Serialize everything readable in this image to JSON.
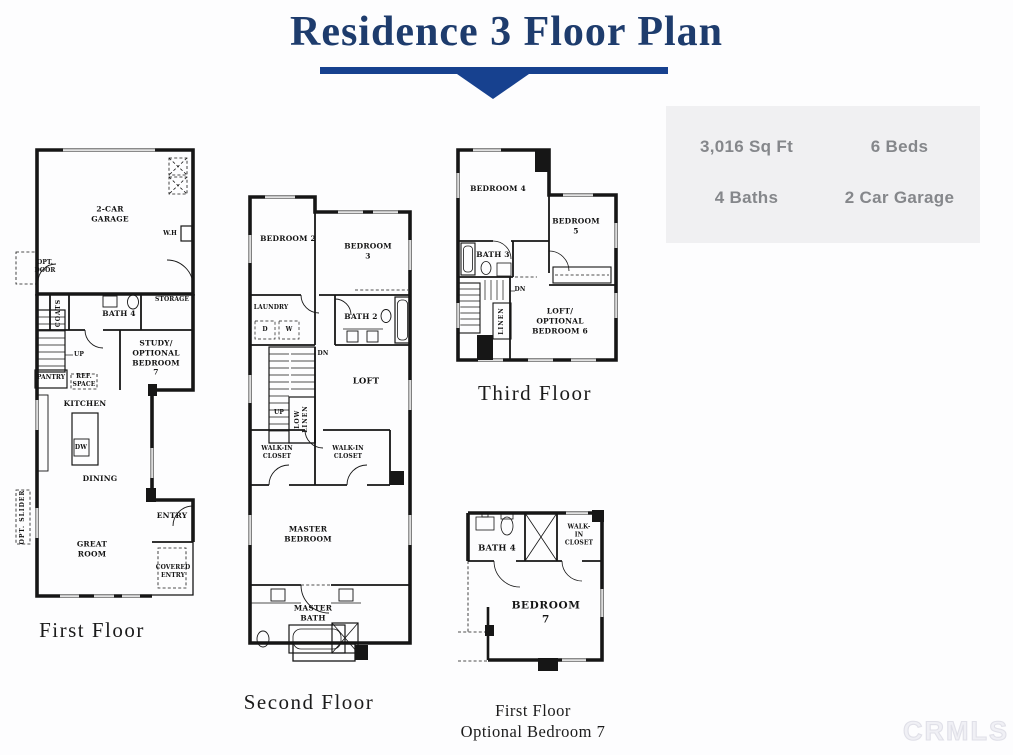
{
  "title": "Residence 3 Floor Plan",
  "stats": {
    "sqft": "3,016 Sq Ft",
    "beds": "6 Beds",
    "baths": "4 Baths",
    "garage": "2 Car Garage"
  },
  "watermark": "CRMLS",
  "colors": {
    "title_blue": "#1e3c6d",
    "bar_blue": "#17418f",
    "panel_gray": "#f0f0f2",
    "stats_text_gray": "#85878b"
  },
  "first_floor": {
    "caption": "First Floor",
    "labels": {
      "garage": "2-CAR\nGARAGE",
      "water_heater": "W.H",
      "opt_door": "OPT.\nDOOR",
      "coats": "COATS",
      "bath4": "BATH 4",
      "storage": "STORAGE",
      "study": "STUDY/\nOPTIONAL\nBEDROOM 7",
      "up": "UP",
      "pantry": "PANTRY",
      "ref_space": "REF.\nSPACE",
      "kitchen": "KITCHEN",
      "dw": "DW",
      "dining": "DINING",
      "opt_slider": "OPT. SLIDER",
      "great_room": "GREAT\nROOM",
      "entry": "ENTRY",
      "covered_entry": "COVERED\nENTRY"
    }
  },
  "second_floor": {
    "caption": "Second Floor",
    "labels": {
      "bedroom2": "BEDROOM 2",
      "bedroom3": "BEDROOM 3",
      "laundry": "LAUNDRY",
      "dryer": "D",
      "washer": "W",
      "bath2": "BATH 2",
      "dn": "DN",
      "up": "UP",
      "low_linen": "LOW\nLINEN",
      "loft": "LOFT",
      "walkin1": "WALK-IN\nCLOSET",
      "walkin2": "WALK-IN\nCLOSET",
      "master_bedroom": "MASTER\nBEDROOM",
      "master_bath": "MASTER\nBATH"
    }
  },
  "third_floor": {
    "caption": "Third Floor",
    "labels": {
      "bedroom4": "BEDROOM 4",
      "bedroom5": "BEDROOM 5",
      "bath3": "BATH 3",
      "dn": "DN",
      "linen": "LINEN",
      "loft_opt": "LOFT/\nOPTIONAL\nBEDROOM 6"
    }
  },
  "optional_floor": {
    "caption": "First Floor\nOptional Bedroom 7",
    "labels": {
      "bath4": "BATH 4",
      "walkin": "WALK-IN\nCLOSET",
      "bedroom7": "BEDROOM 7"
    }
  }
}
